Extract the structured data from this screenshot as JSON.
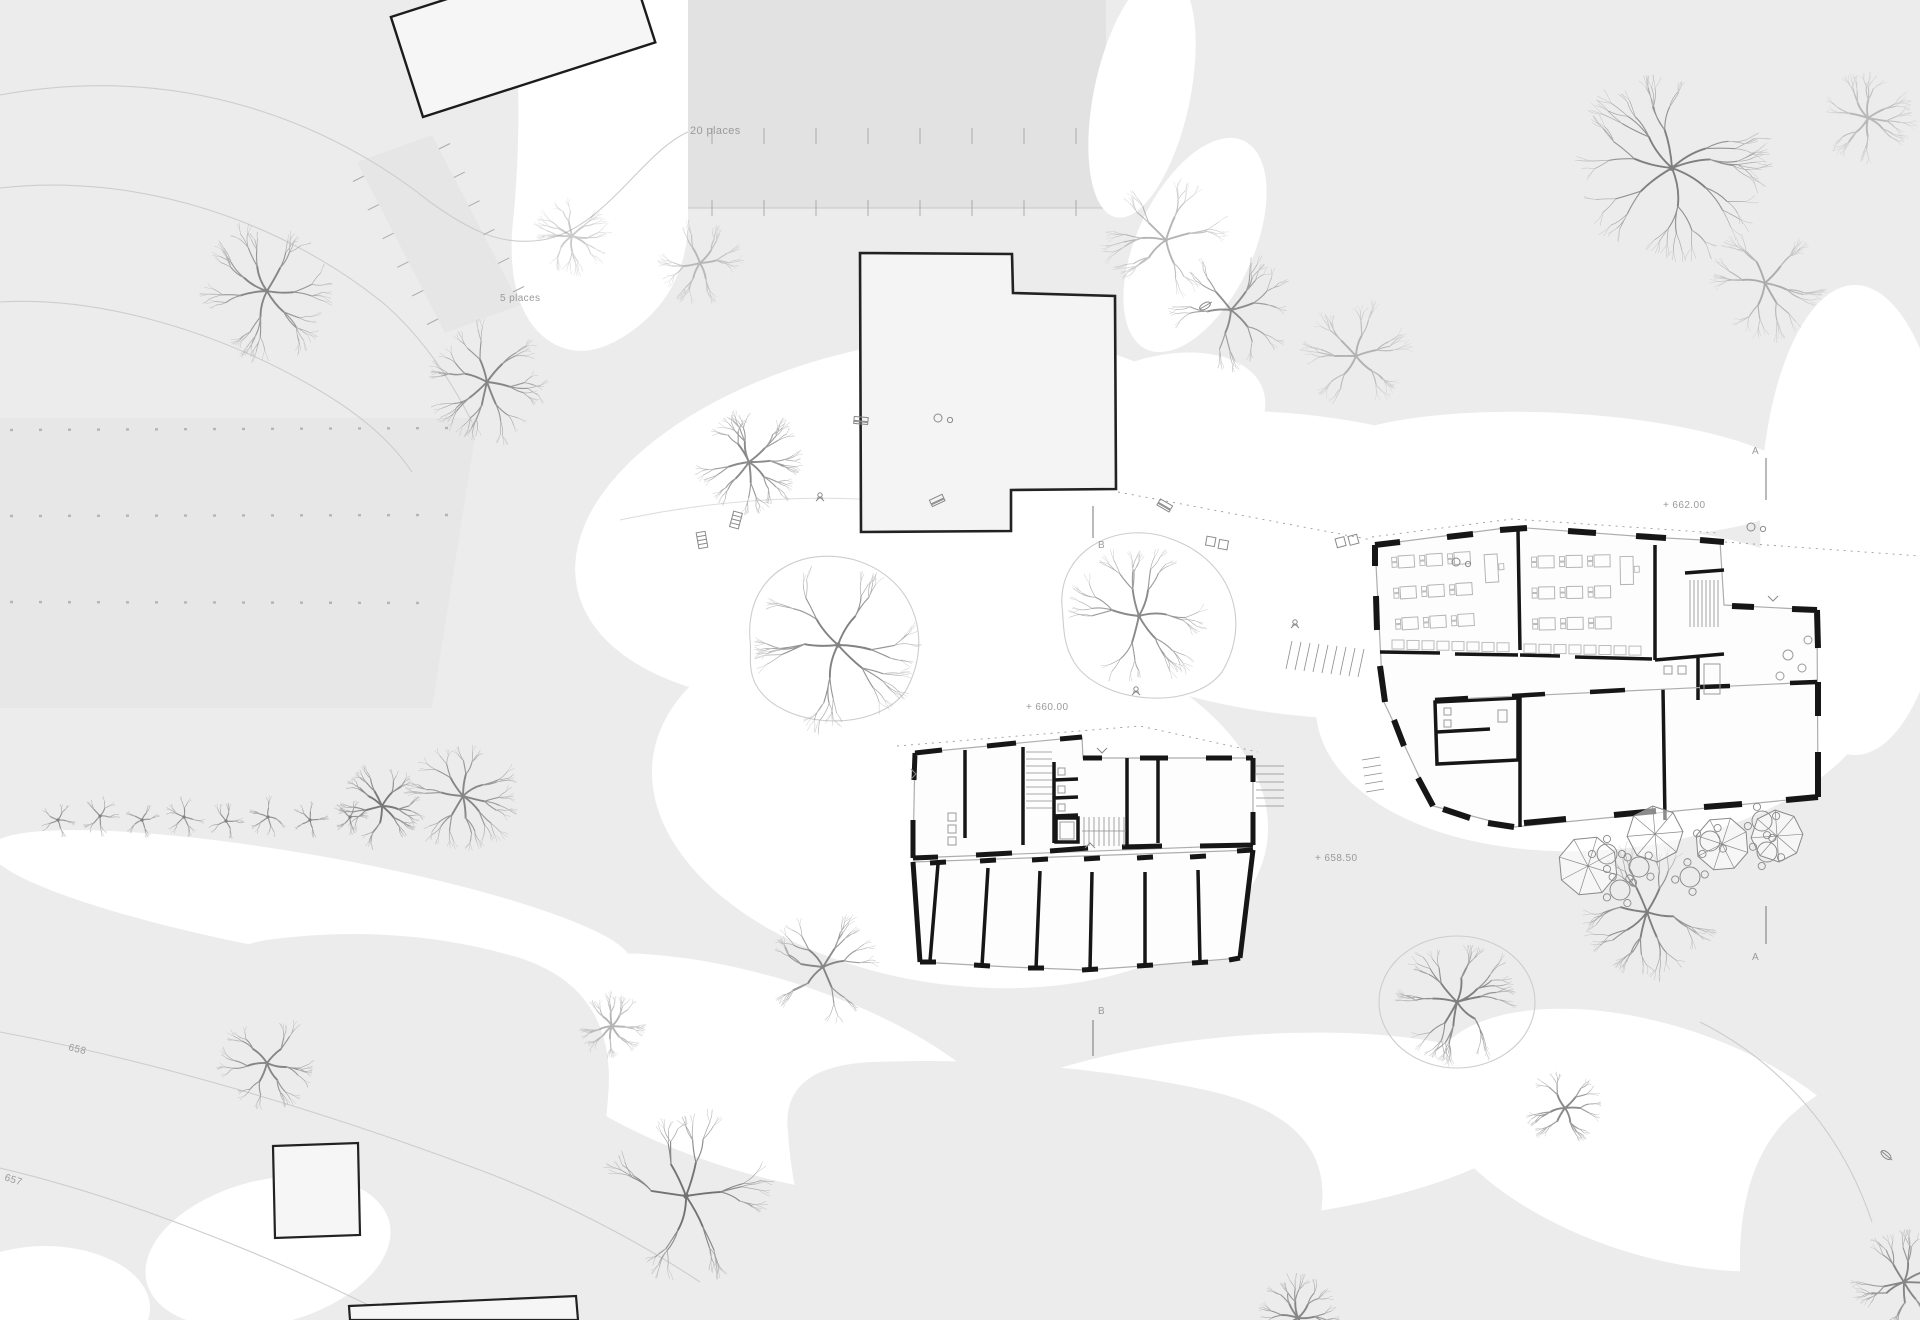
{
  "annotations": [
    {
      "id": "parking-large-label",
      "text": "20 places",
      "x": 690,
      "y": 134,
      "size": 11,
      "rot": 0
    },
    {
      "id": "parking-small-label",
      "text": "5 places",
      "x": 500,
      "y": 301,
      "size": 10,
      "rot": 0
    },
    {
      "id": "level-662-label",
      "text": "+ 662.00",
      "x": 1663,
      "y": 508,
      "size": 10,
      "rot": 0
    },
    {
      "id": "level-660-label",
      "text": "+ 660.00",
      "x": 1026,
      "y": 710,
      "size": 10,
      "rot": 0
    },
    {
      "id": "level-658-label",
      "text": "+ 658.50",
      "x": 1315,
      "y": 861,
      "size": 10,
      "rot": 0
    },
    {
      "id": "contour-658-label",
      "text": "658",
      "x": 68,
      "y": 1050,
      "size": 10,
      "rot": 14
    },
    {
      "id": "contour-657-label",
      "text": "657",
      "x": 4,
      "y": 1180,
      "size": 10,
      "rot": 18
    },
    {
      "id": "section-a-top-label",
      "text": "A",
      "x": 1752,
      "y": 454,
      "size": 10,
      "rot": 0
    },
    {
      "id": "section-a-bottom-label",
      "text": "A",
      "x": 1752,
      "y": 960,
      "size": 10,
      "rot": 0
    },
    {
      "id": "section-b-top-label",
      "text": "B",
      "x": 1098,
      "y": 548,
      "size": 10,
      "rot": 0
    },
    {
      "id": "section-b-bottom-label",
      "text": "B",
      "x": 1098,
      "y": 1014,
      "size": 10,
      "rot": 0
    }
  ],
  "colors": {
    "ground": "#ececec",
    "path": "#ffffff",
    "parking": "#e2e2e2",
    "field": "#e7e7e7",
    "strip": "#e6e6e6",
    "building_fill": "#f6f6f6",
    "room_fill": "#fdfdfd",
    "wall": "#161616",
    "thin_wall": "#adadad",
    "contour": "#cdcdcd",
    "tick": "#ababab",
    "text": "#9a9a9a",
    "furniture": "#b5b5b5",
    "icon": "#8a8a8a",
    "tree_levels": [
      "#b4b4b4",
      "#9d9d9d",
      "#848484",
      "#6d6d6d"
    ]
  },
  "site": {
    "parking_tick_rows": [
      {
        "x1": 712,
        "y1": 128,
        "x2": 1076,
        "y2": 128,
        "n": 8,
        "tx": 0,
        "ty": 16
      },
      {
        "x1": 712,
        "y1": 200,
        "x2": 1076,
        "y2": 200,
        "n": 8,
        "tx": 0,
        "ty": 16
      },
      {
        "x1": 364,
        "y1": 176,
        "x2": 438,
        "y2": 319,
        "n": 6,
        "tx": -11,
        "ty": 5.5
      },
      {
        "x1": 439,
        "y1": 149,
        "x2": 513,
        "y2": 292,
        "n": 6,
        "tx": 11,
        "ty": -5.5
      }
    ],
    "field_rows": [
      {
        "x1": 10,
        "y1": 430,
        "x2": 466,
        "y2": 428
      },
      {
        "x1": 10,
        "y1": 516,
        "x2": 450,
        "y2": 515
      },
      {
        "x1": 10,
        "y1": 602,
        "x2": 436,
        "y2": 603
      }
    ],
    "trees": [
      {
        "x": 267,
        "y": 291,
        "r": 70,
        "seed": 1,
        "o": 0.8
      },
      {
        "x": 487,
        "y": 382,
        "r": 62,
        "seed": 2,
        "o": 0.8
      },
      {
        "x": 749,
        "y": 462,
        "r": 55,
        "seed": 3,
        "o": 0.8
      },
      {
        "x": 838,
        "y": 645,
        "r": 88,
        "seed": 4,
        "o": 0.85
      },
      {
        "x": 700,
        "y": 263,
        "r": 44,
        "seed": 5,
        "o": 0.4
      },
      {
        "x": 1139,
        "y": 616,
        "r": 72,
        "seed": 6,
        "o": 0.8
      },
      {
        "x": 1231,
        "y": 310,
        "r": 62,
        "seed": 7,
        "o": 0.75
      },
      {
        "x": 1356,
        "y": 356,
        "r": 56,
        "seed": 8,
        "o": 0.45
      },
      {
        "x": 1672,
        "y": 168,
        "r": 102,
        "seed": 9,
        "o": 0.85
      },
      {
        "x": 1765,
        "y": 283,
        "r": 60,
        "seed": 10,
        "o": 0.5
      },
      {
        "x": 1868,
        "y": 118,
        "r": 48,
        "seed": 11,
        "o": 0.4
      },
      {
        "x": 463,
        "y": 796,
        "r": 58,
        "seed": 12,
        "o": 0.8
      },
      {
        "x": 267,
        "y": 1063,
        "r": 52,
        "seed": 13,
        "o": 0.8
      },
      {
        "x": 686,
        "y": 1196,
        "r": 92,
        "seed": 14,
        "o": 0.95
      },
      {
        "x": 612,
        "y": 1026,
        "r": 34,
        "seed": 15,
        "o": 0.5
      },
      {
        "x": 823,
        "y": 967,
        "r": 58,
        "seed": 16,
        "o": 0.8
      },
      {
        "x": 1457,
        "y": 1002,
        "r": 64,
        "seed": 17,
        "o": 0.85
      },
      {
        "x": 1565,
        "y": 1108,
        "r": 40,
        "seed": 18,
        "o": 0.8
      },
      {
        "x": 1647,
        "y": 912,
        "r": 70,
        "seed": 19,
        "o": 0.85
      },
      {
        "x": 1904,
        "y": 1282,
        "r": 54,
        "seed": 20,
        "o": 0.8
      },
      {
        "x": 1166,
        "y": 240,
        "r": 64,
        "seed": 21,
        "o": 0.5
      },
      {
        "x": 1298,
        "y": 1318,
        "r": 44,
        "seed": 22,
        "o": 0.8
      },
      {
        "x": 382,
        "y": 806,
        "r": 44,
        "seed": 23,
        "o": 0.9
      },
      {
        "x": 572,
        "y": 236,
        "r": 40,
        "seed": 24,
        "o": 0.35
      },
      {
        "x": 58,
        "y": 820,
        "r": 22,
        "seed": 30,
        "o": 0.85
      },
      {
        "x": 100,
        "y": 816,
        "r": 24,
        "seed": 31,
        "o": 0.85
      },
      {
        "x": 142,
        "y": 820,
        "r": 21,
        "seed": 32,
        "o": 0.85
      },
      {
        "x": 184,
        "y": 817,
        "r": 24,
        "seed": 33,
        "o": 0.85
      },
      {
        "x": 226,
        "y": 821,
        "r": 22,
        "seed": 34,
        "o": 0.85
      },
      {
        "x": 268,
        "y": 817,
        "r": 24,
        "seed": 35,
        "o": 0.85
      },
      {
        "x": 310,
        "y": 820,
        "r": 22,
        "seed": 36,
        "o": 0.85
      },
      {
        "x": 350,
        "y": 817,
        "r": 21,
        "seed": 37,
        "o": 0.85
      }
    ],
    "parasols": [
      {
        "x": 1588,
        "y": 866,
        "r": 30
      },
      {
        "x": 1655,
        "y": 834,
        "r": 28
      },
      {
        "x": 1722,
        "y": 844,
        "r": 27
      },
      {
        "x": 1777,
        "y": 836,
        "r": 26
      }
    ],
    "round_tables": [
      {
        "x": 1607,
        "y": 854
      },
      {
        "x": 1639,
        "y": 867
      },
      {
        "x": 1690,
        "y": 877
      },
      {
        "x": 1710,
        "y": 841
      },
      {
        "x": 1762,
        "y": 821
      },
      {
        "x": 1767,
        "y": 852
      },
      {
        "x": 1620,
        "y": 890
      }
    ],
    "icons": [
      {
        "type": "bench",
        "x": 937,
        "y": 500,
        "rot": -25
      },
      {
        "type": "bench",
        "x": 1165,
        "y": 505,
        "rot": 30
      },
      {
        "type": "bench",
        "x": 861,
        "y": 420,
        "rot": 5
      },
      {
        "type": "dots",
        "x": 944,
        "y": 418,
        "rot": 0
      },
      {
        "type": "table-pair",
        "x": 1217,
        "y": 543,
        "rot": 10
      },
      {
        "type": "table-pair",
        "x": 1347,
        "y": 541,
        "rot": -15
      },
      {
        "type": "figure",
        "x": 1295,
        "y": 625,
        "rot": 0
      },
      {
        "type": "figure",
        "x": 820,
        "y": 498,
        "rot": 0
      },
      {
        "type": "figure",
        "x": 1136,
        "y": 692,
        "rot": 0
      },
      {
        "type": "dots",
        "x": 1757,
        "y": 527,
        "rot": 0
      },
      {
        "type": "dots",
        "x": 1462,
        "y": 562,
        "rot": 0
      },
      {
        "type": "leaf",
        "x": 1886,
        "y": 1155,
        "rot": 40
      },
      {
        "type": "leaf",
        "x": 1205,
        "y": 306,
        "rot": -30
      },
      {
        "type": "ladder",
        "x": 736,
        "y": 520,
        "rot": 15
      },
      {
        "type": "ladder",
        "x": 702,
        "y": 540,
        "rot": -10
      },
      {
        "type": "chevron",
        "x": 1102,
        "y": 750,
        "rot": 0
      },
      {
        "type": "chevron",
        "x": 1090,
        "y": 846,
        "rot": 180
      },
      {
        "type": "chevron",
        "x": 913,
        "y": 774,
        "rot": -90
      },
      {
        "type": "chevron",
        "x": 1773,
        "y": 598,
        "rot": 0
      }
    ],
    "classrooms": [
      {
        "x": 1398,
        "y": 556,
        "cols": 3,
        "rows": 3,
        "dx": 28,
        "dy": 31,
        "rot": -3.5,
        "teacher": {
          "x": 1484,
          "y": 560
        }
      },
      {
        "x": 1538,
        "y": 556,
        "cols": 3,
        "rows": 3,
        "dx": 28,
        "dy": 31,
        "rot": -1,
        "teacher": {
          "x": 1620,
          "y": 558
        }
      }
    ],
    "cabinet_rows": [
      {
        "x": 1392,
        "y": 640,
        "n": 8,
        "dx": 15,
        "w": 12,
        "h": 9,
        "slope": 0.4
      },
      {
        "x": 1524,
        "y": 644,
        "n": 8,
        "dx": 15,
        "w": 12,
        "h": 9,
        "slope": 0.3
      }
    ]
  }
}
